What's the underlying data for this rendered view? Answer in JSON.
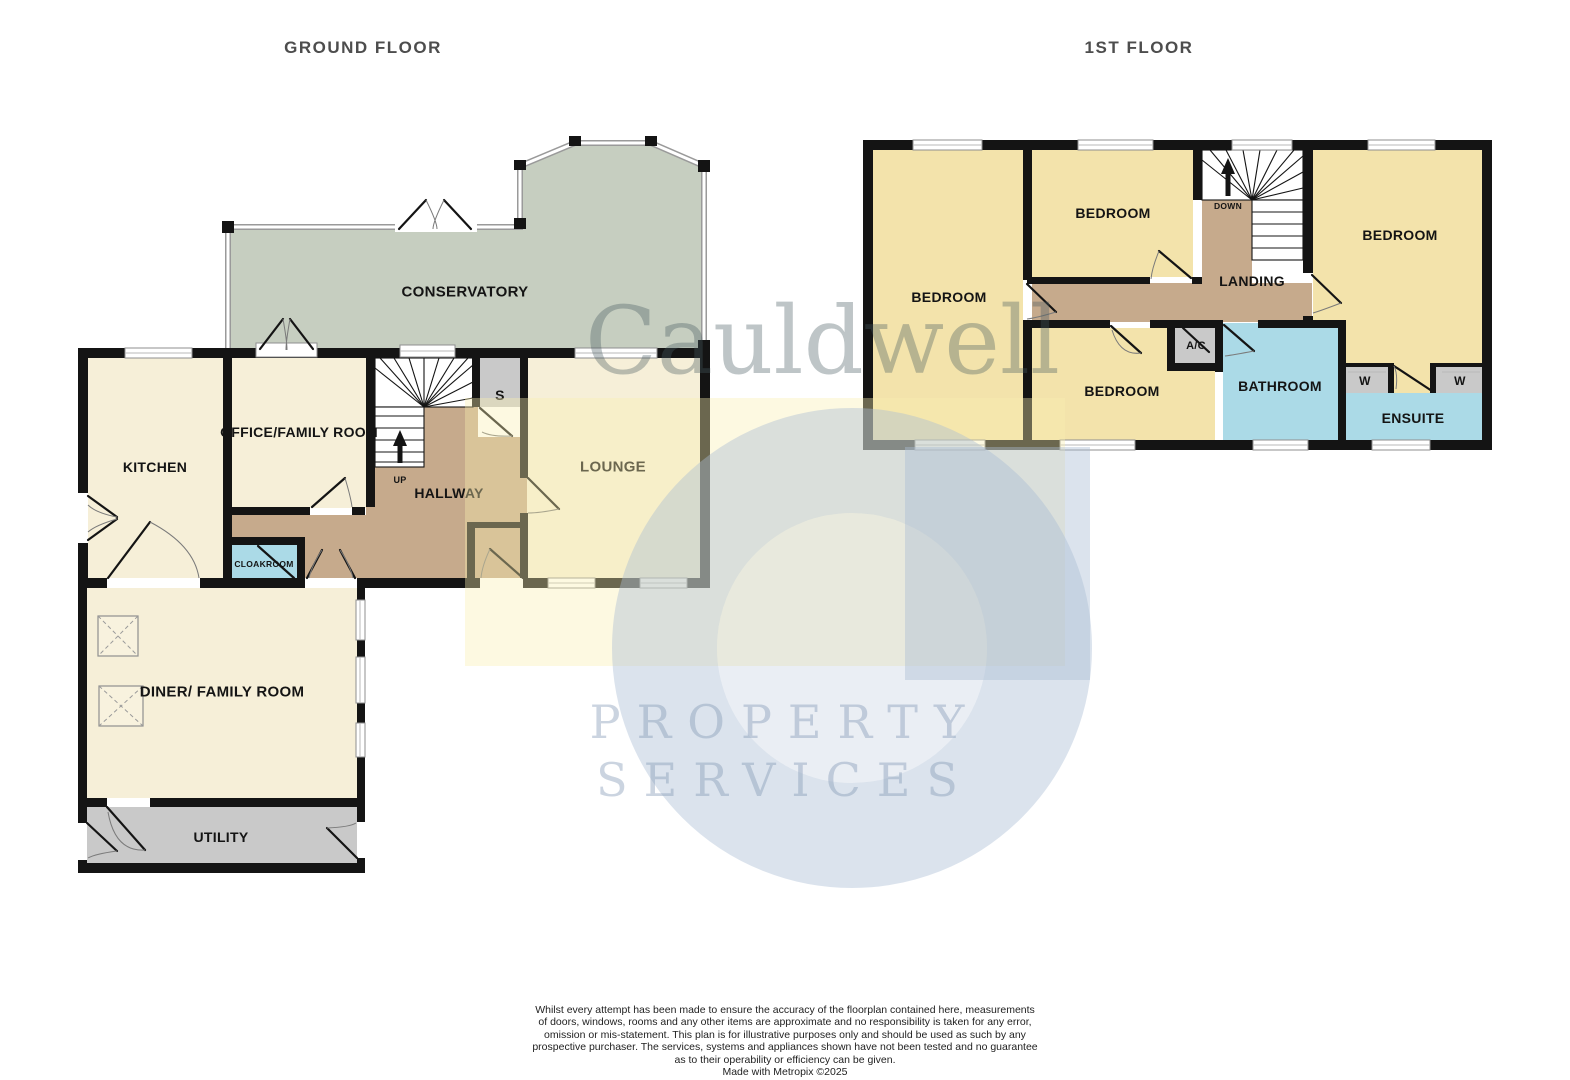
{
  "titles": {
    "ground": "GROUND FLOOR",
    "first": "1ST FLOOR"
  },
  "ground_rooms": {
    "conservatory": "CONSERVATORY",
    "kitchen": "KITCHEN",
    "office": "OFFICE/FAMILY ROOM",
    "hallway": "HALLWAY",
    "lounge": "LOUNGE",
    "store": "S",
    "up": "UP",
    "cloakroom": "CLOAKROOM",
    "diner": "DINER/ FAMILY ROOM",
    "utility": "UTILITY"
  },
  "first_rooms": {
    "bedroom_left": "BEDROOM",
    "bedroom_top": "BEDROOM",
    "bedroom_right": "BEDROOM",
    "bedroom_bottom": "BEDROOM",
    "landing": "LANDING",
    "down": "DOWN",
    "ac": "A/C",
    "bathroom": "BATHROOM",
    "wardrobe_left": "W",
    "wardrobe_right": "W",
    "ensuite": "ENSUITE"
  },
  "watermark": {
    "name": "Cauldwell",
    "line1": "PROPERTY",
    "line2": "SERVICES"
  },
  "footer": {
    "disclaimer": "Whilst every attempt has been made to ensure the accuracy of the floorplan contained here, measurements\nof doors, windows, rooms and any other items are approximate and no responsibility is taken for any error,\nomission or mis-statement. This plan is for illustrative purposes only and should be used as such by any\nprospective purchaser. The services, systems and appliances shown have not been tested and no guarantee\nas to their operability or efficiency can be given.",
    "credit": "Made with Metropix ©2025"
  },
  "colors": {
    "wall": "#141414",
    "yellow": "#F3E3AB",
    "cream": "#F6EFD8",
    "brown": "#C6AA8C",
    "blue": "#ABDAE7",
    "gray": "#C9C9C9",
    "sage": "#C6CEC0",
    "title": "#4D4D4D",
    "label": "#141414",
    "watermark_yellow": "rgba(250,240,175,0.38)",
    "watermark_blue": "rgba(170,188,212,0.42)",
    "watermark_core": "rgba(170,188,212,0.25)",
    "watermark_text": "rgba(70,90,95,0.35)",
    "watermark_services": "rgba(130,152,180,0.42)"
  }
}
